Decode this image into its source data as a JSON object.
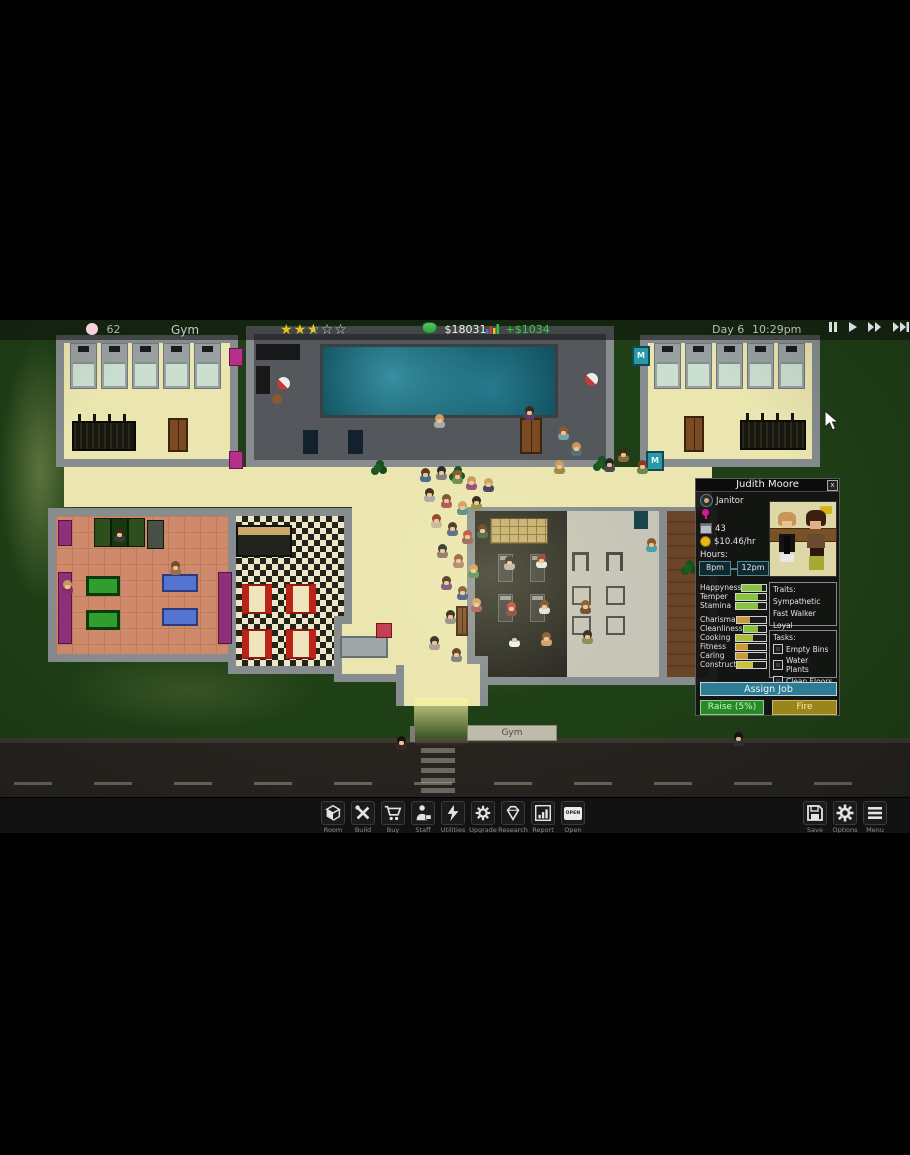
{
  "hud": {
    "population": "62",
    "location_label": "Gym",
    "rating": {
      "full": 2,
      "half": 1,
      "empty": 2
    },
    "money": "$18031",
    "income": "+$1034",
    "day": "Day 6",
    "time": "10:29pm"
  },
  "staff_panel": {
    "name": "Judith Moore",
    "close_label": "x",
    "job": "Janitor",
    "age": "43",
    "wage": "$10.46/hr",
    "hours_label": "Hours:",
    "hours_start": "8pm",
    "hours_end": "12pm",
    "stats": [
      {
        "label": "Happyness",
        "value": 0.85,
        "color": "#86c53a"
      },
      {
        "label": "Temper",
        "value": 0.72,
        "color": "#86c53a"
      },
      {
        "label": "Stamina",
        "value": 0.72,
        "color": "#86c53a"
      },
      {
        "label": "Charisma",
        "value": 0.45,
        "color": "#cc9933"
      },
      {
        "label": "Cleanliness",
        "value": 0.62,
        "color": "#86c53a"
      },
      {
        "label": "Cooking",
        "value": 0.55,
        "color": "#aabf35"
      },
      {
        "label": "Fitness",
        "value": 0.4,
        "color": "#cc9933"
      },
      {
        "label": "Caring",
        "value": 0.4,
        "color": "#cc9933"
      },
      {
        "label": "Construct",
        "value": 0.55,
        "color": "#c9c23a"
      }
    ],
    "traits_label": "Traits:",
    "traits": [
      "Sympathetic",
      "Fast Walker",
      "Loyal"
    ],
    "tasks_label": "Tasks:",
    "tasks": [
      {
        "label": "Empty Bins",
        "checked": false
      },
      {
        "label": "Water Plants",
        "checked": false
      },
      {
        "label": "Clean Floors",
        "checked": false
      }
    ],
    "buttons": {
      "assign": "Assign Job",
      "raise": "Raise (5%)",
      "fire": "Fire"
    }
  },
  "toolbar": {
    "items": [
      {
        "label": "Room",
        "icon": "room-icon"
      },
      {
        "label": "Build",
        "icon": "build-icon"
      },
      {
        "label": "Buy",
        "icon": "buy-icon"
      },
      {
        "label": "Staff",
        "icon": "staff-icon"
      },
      {
        "label": "Utilities",
        "icon": "utilities-icon"
      },
      {
        "label": "Upgrade",
        "icon": "upgrade-icon"
      },
      {
        "label": "Research",
        "icon": "research-icon"
      },
      {
        "label": "Report",
        "icon": "report-icon"
      },
      {
        "label": "Open",
        "icon": "open-icon",
        "sign_text": "OPEN"
      }
    ],
    "right_items": [
      {
        "label": "Save",
        "icon": "save-icon"
      },
      {
        "label": "Options",
        "icon": "options-icon"
      },
      {
        "label": "Menu",
        "icon": "menu-icon"
      }
    ]
  },
  "world": {
    "sign_label": "Gym",
    "machine_label": "M",
    "people": [
      [
        420,
        148,
        "#5a3a1e",
        "#49698f"
      ],
      [
        436,
        146,
        "#26262a",
        "#7d7d7d"
      ],
      [
        452,
        150,
        "#8a5a2a",
        "#6d8c4c"
      ],
      [
        466,
        156,
        "#c89858",
        "#94477b"
      ],
      [
        424,
        168,
        "#3a2a1a",
        "#a8a8a8"
      ],
      [
        441,
        174,
        "#7a4a2a",
        "#ae4f4f"
      ],
      [
        457,
        181,
        "#caa060",
        "#4c8a8a"
      ],
      [
        471,
        176,
        "#2a1a10",
        "#8c8c3e"
      ],
      [
        483,
        158,
        "#caa060",
        "#3c3c5c"
      ],
      [
        431,
        194,
        "#8a3a20",
        "#c4b49c"
      ],
      [
        447,
        202,
        "#3a2a1a",
        "#4f5d86"
      ],
      [
        462,
        210,
        "#c2453f",
        "#8f5b52"
      ],
      [
        477,
        204,
        "#5a3a1e",
        "#3e5c3e"
      ],
      [
        437,
        224,
        "#26262a",
        "#8a6a62"
      ],
      [
        453,
        234,
        "#8a5a2a",
        "#a87b6a"
      ],
      [
        468,
        244,
        "#c89858",
        "#4c8a4c"
      ],
      [
        441,
        256,
        "#3a2a1a",
        "#74477b"
      ],
      [
        457,
        266,
        "#7a4a2a",
        "#39508c"
      ],
      [
        471,
        278,
        "#caa060",
        "#a85555"
      ],
      [
        445,
        290,
        "#2a1a10",
        "#8a8a8a"
      ],
      [
        558,
        106,
        "#8a5a2a",
        "#7aa0a8"
      ],
      [
        571,
        122,
        "#c89858",
        "#56707a"
      ],
      [
        554,
        140,
        "#caa060",
        "#9a8a4a"
      ],
      [
        604,
        138,
        "#26262a",
        "#4a4a4a"
      ],
      [
        637,
        140,
        "#8a3a20",
        "#6a8a4c"
      ],
      [
        618,
        128,
        "#3a2a1a",
        "#8a6a3a"
      ],
      [
        524,
        86,
        "#3a2a1a",
        "#5c3a6a"
      ],
      [
        434,
        94,
        "#caa060",
        "#a8a8a8"
      ],
      [
        62,
        260,
        "#c89858",
        "#8a2a6a"
      ],
      [
        170,
        241,
        "#7a4a2a",
        "#96704a"
      ],
      [
        114,
        208,
        "#3a2a1a",
        "#3a3a3a"
      ],
      [
        504,
        236,
        "#26262a",
        "#b0b0b0"
      ],
      [
        536,
        234,
        "#8a3a20",
        "#e8e8e8"
      ],
      [
        506,
        282,
        "#c2453f",
        "#8a3a3a"
      ],
      [
        539,
        280,
        "#7a4a2a",
        "#e0e0e0"
      ],
      [
        580,
        280,
        "#8a5a2a",
        "#6a4a2a"
      ],
      [
        509,
        313,
        "#26262a",
        "#f0f0f0"
      ],
      [
        541,
        312,
        "#8a5a2a",
        "#caa06a"
      ],
      [
        582,
        310,
        "#3a2a1a",
        "#8a8a5a"
      ],
      [
        451,
        328,
        "#5a3a1e",
        "#7d7d7d"
      ],
      [
        429,
        316,
        "#26262a",
        "#a89a92"
      ],
      [
        646,
        218,
        "#8a5a2a",
        "#4aa0a8"
      ],
      [
        396,
        416,
        "#151515",
        "#3c2424"
      ],
      [
        733,
        412,
        "#151515",
        "#333333"
      ]
    ]
  }
}
